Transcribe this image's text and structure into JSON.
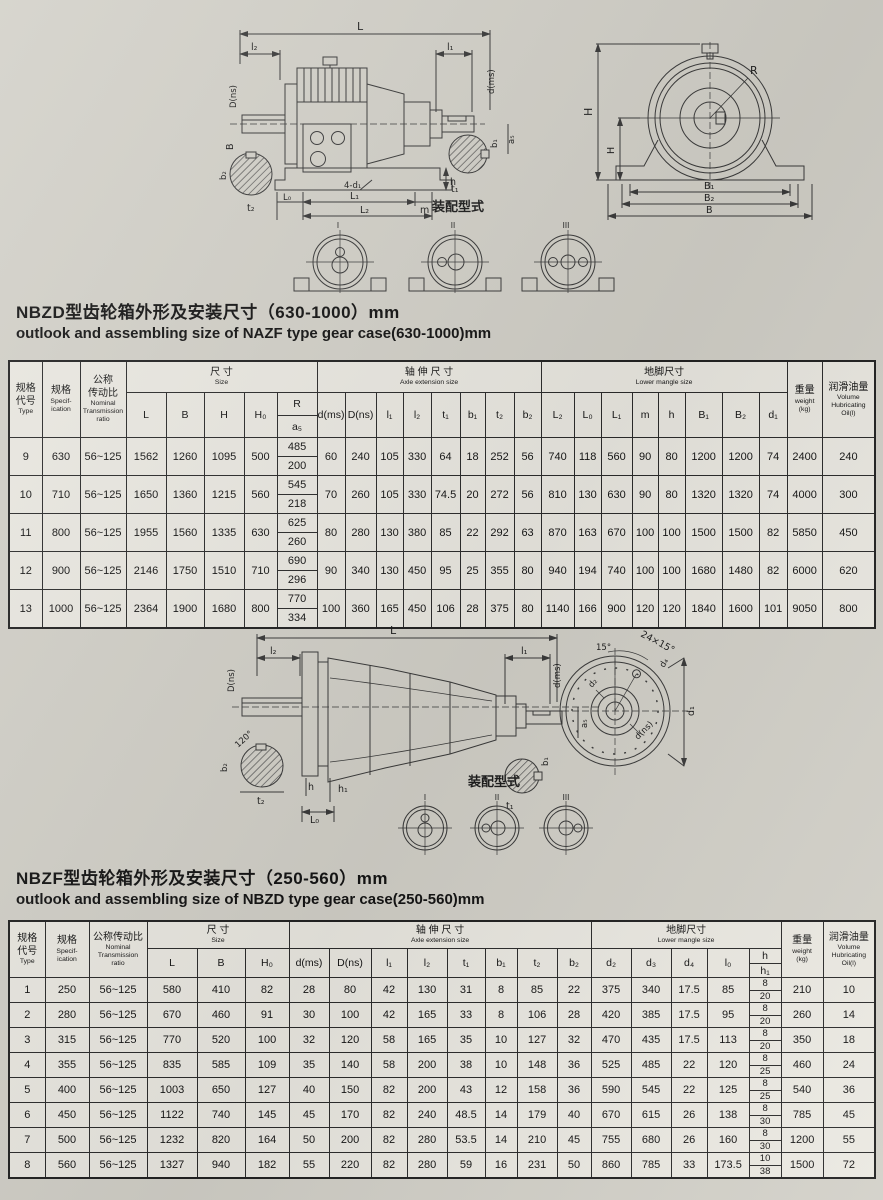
{
  "titles": {
    "t1_zh": "NBZD型齿轮箱外形及安装尺寸（630-1000）mm",
    "t1_en": "outlook and assembling size of NAZF type gear case(630-1000)mm",
    "t2_zh": "NBZF型齿轮箱外形及安装尺寸（250-560）mm",
    "t2_en": "outlook and assembling size of NBZD type gear case(250-560)mm"
  },
  "drawing1": {
    "side": {
      "L": "L",
      "l2": "l₂",
      "l1": "l₁",
      "Dns": "D(ns)",
      "B": "B",
      "dms": "d(ms)",
      "a5": "a₅",
      "t2": "t₂",
      "b2": "b₂",
      "t1": "t₁",
      "b1": "b₁",
      "L0": "L₀",
      "L1": "L₁",
      "holes": "4-d₁",
      "m": "m",
      "L2": "L₂",
      "h": "h"
    },
    "front": {
      "R": "R",
      "H": "H",
      "H2": "H",
      "B1": "B₁",
      "B2": "B₂",
      "B": "B"
    },
    "assembly": "装配型式",
    "marks": [
      "I",
      "II",
      "III"
    ]
  },
  "drawing2": {
    "side": {
      "L": "L",
      "l2": "l₂",
      "l1": "l₁",
      "Dns": "D(ns)",
      "dms": "d(ms)",
      "a5": "a₅",
      "deg120": "120°",
      "b2": "b₂",
      "t2": "t₂",
      "h": "h",
      "h1": "h₁",
      "L0": "L₀",
      "t1": "t₁",
      "b1": "b₁"
    },
    "front": {
      "bolt": "24×15°",
      "deg15": "15°",
      "d4": "d₄",
      "d2": "d₂",
      "dns": "d(ns)",
      "d1": "d₁"
    },
    "assembly": "装配型式",
    "marks": [
      "I",
      "II",
      "III"
    ]
  },
  "table1": {
    "header": {
      "type_zh": "规格\n代号",
      "type_en": "Type",
      "spec_zh": "规格",
      "spec_en": "Specif-\nication",
      "ratio_zh": "公称\n传动比",
      "ratio_en": "Nominal\nTransmission\nratio",
      "size_zh": "尺 寸",
      "size_en": "Size",
      "axle_zh": "轴 伸 尺 寸",
      "axle_en": "Axle extension size",
      "foot_zh": "地脚尺寸",
      "foot_en": "Lower mangle size",
      "weight_zh": "重量",
      "weight_en": "weight\n(kg)",
      "oil_zh": "润滑油量",
      "oil_en": "Volume\nHubricating\nOil(l)",
      "size_cols": [
        "L",
        "B",
        "H",
        "H₀"
      ],
      "r_top": "R",
      "r_bottom": "a₅",
      "axle_cols": [
        "d(ms)",
        "D(ns)",
        "l₁",
        "l₂",
        "t₁",
        "b₁",
        "t₂",
        "b₂"
      ],
      "foot_cols": [
        "L₂",
        "L₀",
        "L₁",
        "m",
        "h",
        "B₁",
        "B₂",
        "d₁"
      ]
    },
    "rows": [
      [
        "9",
        "630",
        "56~125",
        "1562",
        "1260",
        "1095",
        "500",
        [
          "485",
          "200"
        ],
        "60",
        "240",
        "105",
        "330",
        "64",
        "18",
        "252",
        "56",
        "740",
        "118",
        "560",
        "90",
        "80",
        "1200",
        "1200",
        "74",
        "2400",
        "240"
      ],
      [
        "10",
        "710",
        "56~125",
        "1650",
        "1360",
        "1215",
        "560",
        [
          "545",
          "218"
        ],
        "70",
        "260",
        "105",
        "330",
        "74.5",
        "20",
        "272",
        "56",
        "810",
        "130",
        "630",
        "90",
        "80",
        "1320",
        "1320",
        "74",
        "4000",
        "300"
      ],
      [
        "11",
        "800",
        "56~125",
        "1955",
        "1560",
        "1335",
        "630",
        [
          "625",
          "260"
        ],
        "80",
        "280",
        "130",
        "380",
        "85",
        "22",
        "292",
        "63",
        "870",
        "163",
        "670",
        "100",
        "100",
        "1500",
        "1500",
        "82",
        "5850",
        "450"
      ],
      [
        "12",
        "900",
        "56~125",
        "2146",
        "1750",
        "1510",
        "710",
        [
          "690",
          "296"
        ],
        "90",
        "340",
        "130",
        "450",
        "95",
        "25",
        "355",
        "80",
        "940",
        "194",
        "740",
        "100",
        "100",
        "1680",
        "1480",
        "82",
        "6000",
        "620"
      ],
      [
        "13",
        "1000",
        "56~125",
        "2364",
        "1900",
        "1680",
        "800",
        [
          "770",
          "334"
        ],
        "100",
        "360",
        "165",
        "450",
        "106",
        "28",
        "375",
        "80",
        "1140",
        "166",
        "900",
        "120",
        "120",
        "1840",
        "1600",
        "101",
        "9050",
        "800"
      ]
    ]
  },
  "table2": {
    "header": {
      "type_zh": "规格\n代号",
      "type_en": "Type",
      "spec_zh": "规格",
      "spec_en": "Specif-\nication",
      "ratio_zh": "公称传动比",
      "ratio_en": "Nominal\nTransmission\nratio",
      "size_zh": "尺 寸",
      "size_en": "Size",
      "axle_zh": "轴 伸 尺 寸",
      "axle_en": "Axle extension size",
      "foot_zh": "地脚尺寸",
      "foot_en": "Lower mangle size",
      "weight_zh": "重量",
      "weight_en": "weight\n(kg)",
      "oil_zh": "润滑油量",
      "oil_en": "Volume\nHubricating\nOil(l)",
      "size_cols": [
        "L",
        "B",
        "H₀"
      ],
      "axle_cols": [
        "d(ms)",
        "D(ns)",
        "l₁",
        "l₂",
        "t₁",
        "b₁",
        "t₂",
        "b₂"
      ],
      "foot_cols": [
        "d₂",
        "d₃",
        "d₄",
        "l₀"
      ],
      "h_top": "h",
      "h_bottom": "h₁"
    },
    "rows": [
      [
        "1",
        "250",
        "56~125",
        "580",
        "410",
        "82",
        "28",
        "80",
        "42",
        "130",
        "31",
        "8",
        "85",
        "22",
        "375",
        "340",
        "17.5",
        "85",
        [
          "8",
          "20"
        ],
        "210",
        "10"
      ],
      [
        "2",
        "280",
        "56~125",
        "670",
        "460",
        "91",
        "30",
        "100",
        "42",
        "165",
        "33",
        "8",
        "106",
        "28",
        "420",
        "385",
        "17.5",
        "95",
        [
          "8",
          "20"
        ],
        "260",
        "14"
      ],
      [
        "3",
        "315",
        "56~125",
        "770",
        "520",
        "100",
        "32",
        "120",
        "58",
        "165",
        "35",
        "10",
        "127",
        "32",
        "470",
        "435",
        "17.5",
        "113",
        [
          "8",
          "20"
        ],
        "350",
        "18"
      ],
      [
        "4",
        "355",
        "56~125",
        "835",
        "585",
        "109",
        "35",
        "140",
        "58",
        "200",
        "38",
        "10",
        "148",
        "36",
        "525",
        "485",
        "22",
        "120",
        [
          "8",
          "25"
        ],
        "460",
        "24"
      ],
      [
        "5",
        "400",
        "56~125",
        "1003",
        "650",
        "127",
        "40",
        "150",
        "82",
        "200",
        "43",
        "12",
        "158",
        "36",
        "590",
        "545",
        "22",
        "125",
        [
          "8",
          "25"
        ],
        "540",
        "36"
      ],
      [
        "6",
        "450",
        "56~125",
        "1122",
        "740",
        "145",
        "45",
        "170",
        "82",
        "240",
        "48.5",
        "14",
        "179",
        "40",
        "670",
        "615",
        "26",
        "138",
        [
          "8",
          "30"
        ],
        "785",
        "45"
      ],
      [
        "7",
        "500",
        "56~125",
        "1232",
        "820",
        "164",
        "50",
        "200",
        "82",
        "280",
        "53.5",
        "14",
        "210",
        "45",
        "755",
        "680",
        "26",
        "160",
        [
          "8",
          "30"
        ],
        "1200",
        "55"
      ],
      [
        "8",
        "560",
        "56~125",
        "1327",
        "940",
        "182",
        "55",
        "220",
        "82",
        "280",
        "59",
        "16",
        "231",
        "50",
        "860",
        "785",
        "33",
        "173.5",
        [
          "10",
          "38"
        ],
        "1500",
        "72"
      ]
    ]
  }
}
